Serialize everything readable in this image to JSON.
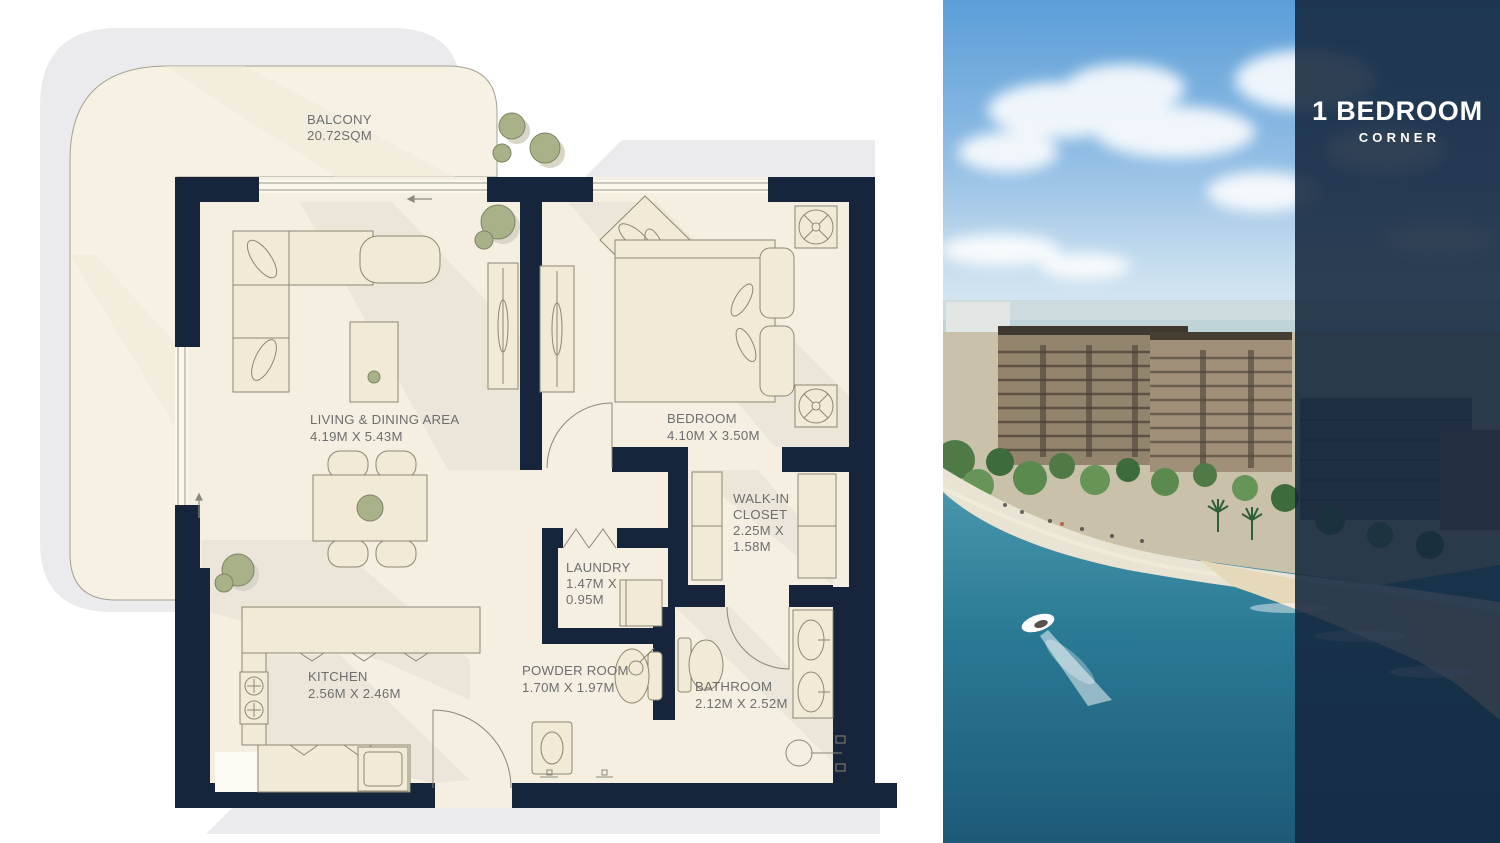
{
  "panel": {
    "title": "1 BEDROOM",
    "subtitle": "CORNER"
  },
  "floor_plan": {
    "balcony": {
      "name": "BALCONY",
      "area": "20.72SQM"
    },
    "living_dining": {
      "name": "LIVING & DINING AREA",
      "dimensions": "4.19M X 5.43M"
    },
    "bedroom": {
      "name": "BEDROOM",
      "dimensions": "4.10M X 3.50M"
    },
    "walk_in_closet": {
      "name_line1": "WALK-IN",
      "name_line2": "CLOSET",
      "dim_line1": "2.25M X",
      "dim_line2": "1.58M"
    },
    "laundry": {
      "name": "LAUNDRY",
      "dim_line1": "1.47M X",
      "dim_line2": "0.95M"
    },
    "powder_room": {
      "name": "POWDER ROOM",
      "dimensions": "1.70M X 1.97M"
    },
    "kitchen": {
      "name": "KITCHEN",
      "dimensions": "2.56M X 2.46M"
    },
    "bathroom": {
      "name": "BATHROOM",
      "dimensions": "2.12M X 2.52M"
    }
  },
  "colors": {
    "wall_navy": "#16243c",
    "floor_cream": "#f5efe1",
    "balcony_cream": "#f6f1e2",
    "plan_shadow_gray": "#ebebee",
    "furniture_cream": "#f1ead7",
    "furniture_border": "#8d8672",
    "plant_olive": "#a9b189",
    "label_gray": "#6e6e6e",
    "overlay_navy": "#14273d",
    "water_teal": "#2a7a95",
    "sky_blue": "#5b9ed8",
    "sand": "#e6d9ba"
  }
}
